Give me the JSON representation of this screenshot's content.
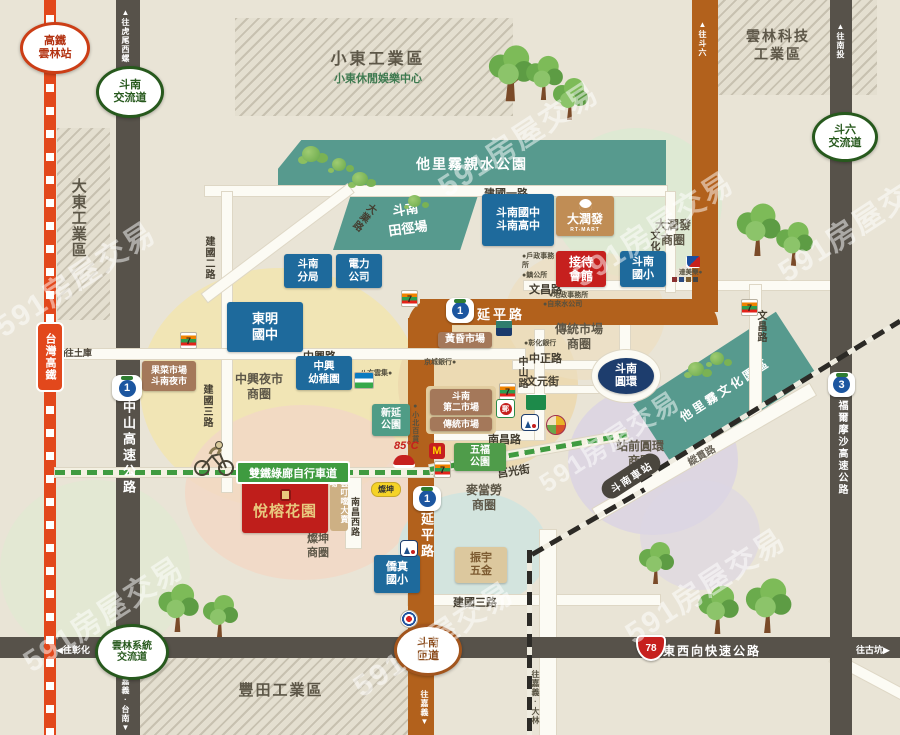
{
  "watermark": "591房屋交易",
  "colors": {
    "background": "#e9e4d6",
    "road_dark": "#57524a",
    "road_brown": "#b2611c",
    "hsr_red": "#e2481c",
    "railway_black": "#2c2a26",
    "bike_green": "#3f9b40",
    "school_blue": "#1e6a9c",
    "landmark_red": "#c6201e",
    "park_teal": "#579a8e",
    "park_green": "#4f9c4a",
    "market_brown": "#a4785a",
    "rtmart_tan": "#c08d55",
    "roundabout_navy": "#1d3d6d",
    "interchange_green": "#27591d",
    "shield_blue": "#1c56a0"
  },
  "property": {
    "name": "悅榕花園"
  },
  "interchanges": {
    "hsr_station_1": "高鐵",
    "hsr_station_2": "雲林站",
    "dounan_ic_1": "斗南",
    "dounan_ic_2": "交流道",
    "douliu_ic_1": "斗六",
    "douliu_ic_2": "交流道",
    "yunlin_sys_1": "雲林系統",
    "yunlin_sys_2": "交流道",
    "dounan_ramp_1": "斗南",
    "dounan_ramp_2": "匝道"
  },
  "highways": {
    "shield_1": "1",
    "shield_3": "3",
    "shield_78": "78",
    "zhongshan": "中山高速公路",
    "formosa": "福爾摩沙高速公路",
    "expressway": "東西向快速公路",
    "yanping": "延平路",
    "hsr": "台灣高鐵"
  },
  "directions": {
    "huwei": "▲往虎尾西螺",
    "nantou": "▲往南投",
    "douliu": "▲往斗六",
    "tuku": "◀往土庫",
    "changhua": "◀往彰化",
    "gukeng": "往古坑▶",
    "jiayi": "往嘉義▼",
    "jiayi_tainan": "往嘉義·台南▼",
    "tainan_baihe": "往台南·白河▼",
    "jiayi_dalin": "往嘉義·大林"
  },
  "transit": {
    "station": "斗南車站",
    "roundabout_1": "斗南",
    "roundabout_2": "圓環",
    "bike_path": "雙鐵綠廊自行車道"
  },
  "streets": {
    "jianguo1": "建國一路",
    "jianguo2": "建國二路",
    "jianguo3": "建國三路",
    "jianguo3b": "建國三路",
    "zhongxing": "中興路",
    "zhongzheng": "中正路",
    "zhongshan_rd": "中山路",
    "wenchang": "文昌路",
    "wenchang_r": "文昌路",
    "wenhua": "文化街",
    "wenyuan": "文元街",
    "nanchang": "南昌路",
    "nanchang_w": "南昌西路",
    "daye": "大業路",
    "juguang": "莒光街",
    "zongguan": "縱貫路"
  },
  "zones": {
    "xiaodong": "小東工業區",
    "xiaodong_sub": "小東休閒娛樂中心",
    "yunlin_tech_1": "雲林科技",
    "yunlin_tech_2": "工業區",
    "dadong": "大東工業區",
    "fengtian": "豐田工業區"
  },
  "parks": {
    "taliwu_water": "他里霧親水公園",
    "track_1": "斗南",
    "track_2": "田徑場",
    "culture": "他里霧文化園區",
    "xinyan_1": "新延",
    "xinyan_2": "公園",
    "wufu_1": "五福",
    "wufu_2": "公園"
  },
  "schools": {
    "dounan_jh_1": "斗南國中",
    "dounan_jh_2": "斗南高中",
    "dounan_es_1": "斗南",
    "dounan_es_2": "國小",
    "dongming_1": "東明",
    "dongming_2": "國中",
    "zhongxing_kg_1": "中興",
    "zhongxing_kg_2": "幼稚園",
    "qiaozhen_1": "僑真",
    "qiaozhen_2": "國小"
  },
  "buildings": {
    "police_1": "斗南",
    "police_2": "分局",
    "power_1": "電力",
    "power_2": "公司",
    "rtmart": "大潤發",
    "rtmart_sub": "RT-MART",
    "reception_1": "接待",
    "reception_2": "會館",
    "zhenyu_1": "振宇",
    "zhenyu_2": "五金",
    "yundingdang": "雲叮噹大賣場"
  },
  "markets": {
    "fruit_1": "果菜市場",
    "fruit_2": "斗南夜市",
    "huanghun": "黃昏市場",
    "second_1": "斗南",
    "second_2": "第二市場",
    "second_3": "傳統市場"
  },
  "areas": {
    "rtmart_1": "大潤發",
    "rtmart_2": "商圈",
    "traditional_1": "傳統市場",
    "traditional_2": "商圈",
    "zhongxing_1": "中興夜市",
    "zhongxing_2": "商圈",
    "mcd_1": "麥當勞",
    "mcd_2": "商圈",
    "tsannkuen_1": "燦坤",
    "tsannkuen_2": "商圈",
    "station_1": "站前圓環",
    "station_2": "商圈"
  },
  "pois": {
    "huzheng": "●戶政事務所",
    "zhengongsuo": "●鎮公所",
    "dizheng": "●地政事務所",
    "water_co": "●自來水公司",
    "chb": "●彰化銀行",
    "kingcity": "京城銀行●",
    "bafang": "八方雲集●",
    "xiaobei": "●小北百貨",
    "dominos": "達美樂●"
  },
  "brands": {
    "seven": "7",
    "mcd": "M",
    "post": "郵",
    "tsannkuen": "燦坤",
    "c85": "85°C"
  }
}
